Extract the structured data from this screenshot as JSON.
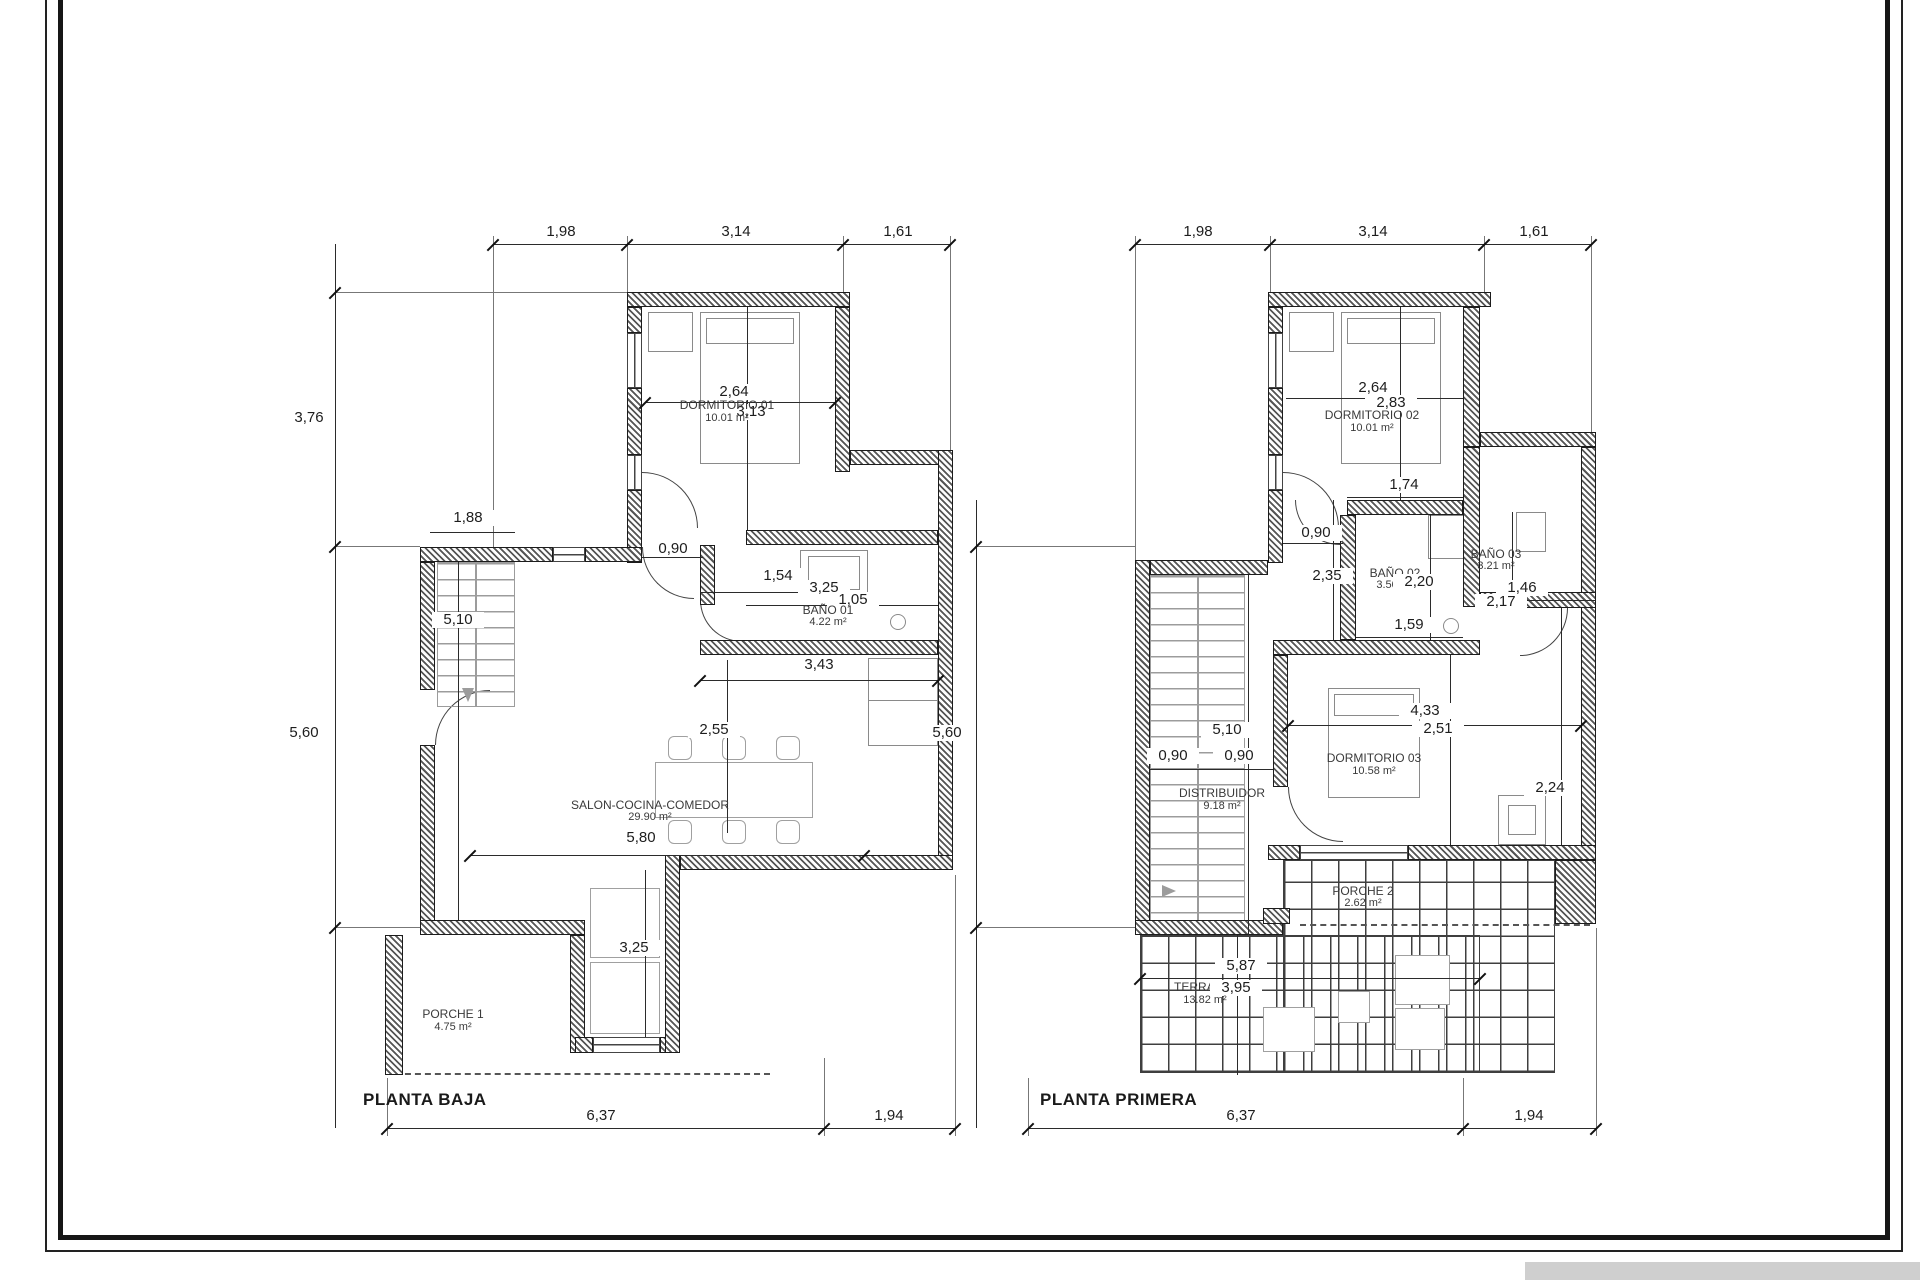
{
  "sheet": {
    "colors": {
      "wall_hatch": "#555555",
      "line": "#2b2b2b",
      "stairs_gray": "#9c9c9c",
      "frame": "#161616",
      "artifact_gray": "#cfcfcf"
    }
  },
  "planta_baja": {
    "title": "PLANTA BAJA",
    "dims": {
      "t1": "1,98",
      "t2": "3,14",
      "t3": "1,61",
      "l1": "3,76",
      "l2": "5,60",
      "b1": "6,37",
      "b2": "1,94",
      "d264": "2,64",
      "d313": "3,13",
      "d090": "0,90",
      "d154": "1,54",
      "d325a": "3,25",
      "d105": "1,05",
      "d188": "1,88",
      "d343": "3,43",
      "d510": "5,10",
      "d255": "2,55",
      "d580": "5,80",
      "d325b": "3,25"
    },
    "rooms": {
      "dormitorio": {
        "name": "DORMITORIO 01",
        "area": "10.01 m²"
      },
      "bano": {
        "name": "BAÑO 01",
        "area": "4.22 m²"
      },
      "salon": {
        "name": "SALON-COCINA-COMEDOR",
        "area": "29.90 m²"
      },
      "porche": {
        "name": "PORCHE 1",
        "area": "4.75 m²"
      }
    }
  },
  "planta_primera": {
    "title": "PLANTA PRIMERA",
    "dims": {
      "t1": "1,98",
      "t2": "3,14",
      "t3": "1,61",
      "l1": "5,60",
      "b1": "6,37",
      "b2": "1,94",
      "d264": "2,64",
      "d283": "2,83",
      "d174": "1,74",
      "d090a": "0,90",
      "d235": "2,35",
      "d220": "2,20",
      "d159": "1,59",
      "d146": "1,46",
      "d217": "2,17",
      "d433": "4,33",
      "d251": "2,51",
      "d224": "2,24",
      "d510": "5,10",
      "d090b": "0,90",
      "d090c": "0,90",
      "d587": "5,87",
      "d395": "3,95"
    },
    "rooms": {
      "dormitorio2": {
        "name": "DORMITORIO 02",
        "area": "10.01 m²"
      },
      "bano2": {
        "name": "BAÑO 02",
        "area": "3.50 m²"
      },
      "bano3": {
        "name": "BAÑO 03",
        "area": "3.21 m²"
      },
      "dormitorio3": {
        "name": "DORMITORIO 03",
        "area": "10.58 m²"
      },
      "distribuidor": {
        "name": "DISTRIBUIDOR",
        "area": "9.18 m²"
      },
      "porche2": {
        "name": "PORCHE 2",
        "area": "2.62 m²"
      },
      "terraza": {
        "name": "TERRAZA",
        "area": "13.82 m²"
      }
    }
  }
}
